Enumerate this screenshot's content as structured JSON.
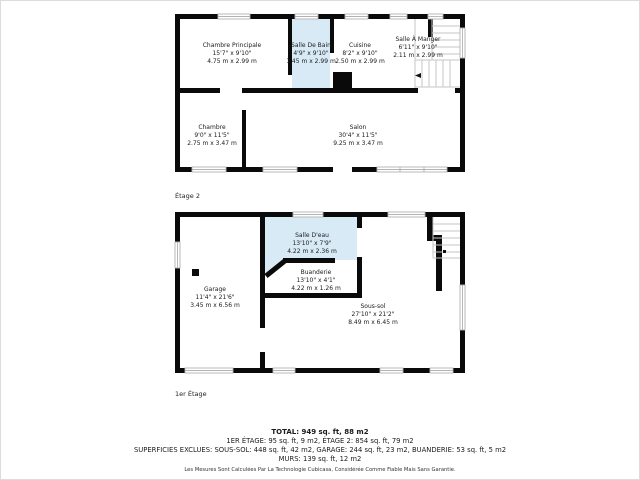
{
  "colors": {
    "wall": "#0a0a0a",
    "wet_room_fill": "#d9eaf7",
    "stair_line": "#c6c6c6",
    "window_frame": "#b3b3b3"
  },
  "floor2": {
    "label": "Étage 2",
    "rooms": {
      "chambre_principale": {
        "name": "Chambre Principale",
        "imperial": "15'7\" x 9'10\"",
        "metric": "4.75 m x 2.99 m"
      },
      "salle_de_bain": {
        "name": "Salle De Bain",
        "imperial": "4'9\" x 9'10\"",
        "metric": "1.45 m x 2.99 m"
      },
      "cuisine": {
        "name": "Cuisine",
        "imperial": "8'2\" x 9'10\"",
        "metric": "2.50 m x 2.99 m"
      },
      "salle_a_manger": {
        "name": "Salle À Manger",
        "imperial": "6'11\" x 9'10\"",
        "metric": "2.11 m x 2.99 m"
      },
      "chambre": {
        "name": "Chambre",
        "imperial": "9'0\" x 11'5\"",
        "metric": "2.75 m x 3.47 m"
      },
      "salon": {
        "name": "Salon",
        "imperial": "30'4\" x 11'5\"",
        "metric": "9.25 m x 3.47 m"
      }
    }
  },
  "floor1": {
    "label": "1er Étage",
    "rooms": {
      "salle_deau": {
        "name": "Salle D'eau",
        "imperial": "13'10\" x 7'9\"",
        "metric": "4.22 m x 2.36 m"
      },
      "buanderie": {
        "name": "Buanderie",
        "imperial": "13'10\" x 4'1\"",
        "metric": "4.22 m x 1.26 m"
      },
      "garage": {
        "name": "Garage",
        "imperial": "11'4\" x 21'6\"",
        "metric": "3.45 m x 6.56 m"
      },
      "sous_sol": {
        "name": "Sous-sol",
        "imperial": "27'10\" x 21'2\"",
        "metric": "8.49 m x 6.45 m"
      }
    }
  },
  "summary": {
    "total": "TOTAL: 949 sq. ft, 88 m2",
    "etages": "1ER ÉTAGE: 95 sq. ft, 9 m2, ÉTAGE 2: 854 sq. ft, 79 m2",
    "exclusions": "SUPERFICIES EXCLUES: SOUS-SOL: 448 sq. ft, 42 m2, GARAGE: 244 sq. ft, 23 m2, BUANDERIE: 53 sq. ft, 5 m2",
    "murs": "MURS: 139 sq. ft, 12 m2"
  },
  "disclaimer": "Les Mesures Sont Calculées Par La Technologie Cubicasa, Considérée Comme Fiable Mais Sans Garantie."
}
